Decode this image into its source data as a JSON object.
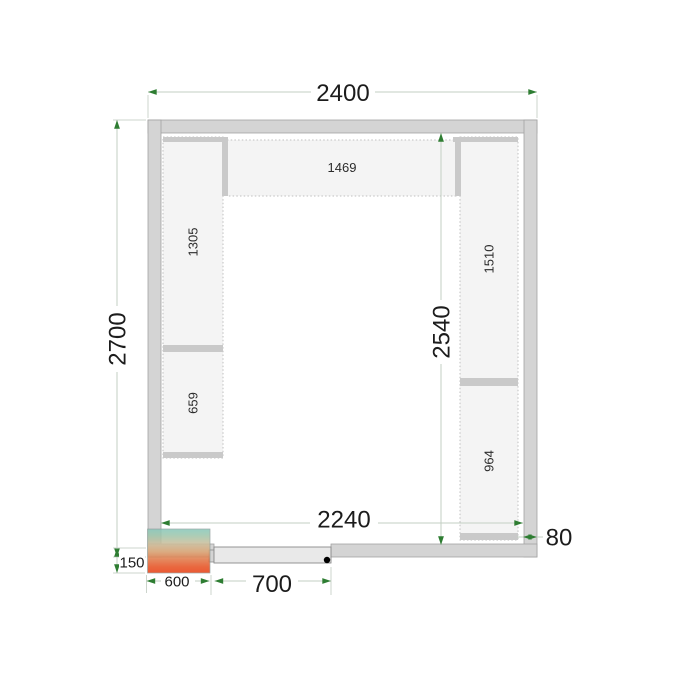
{
  "diagram": {
    "title": "cold-room-floor-plan",
    "dimensions": {
      "outer_width": "2400",
      "outer_depth": "2700",
      "inner_width": "2240",
      "inner_depth": "2540",
      "wall_thickness": "80",
      "unit_overhang": "150",
      "unit_width": "600",
      "door_opening": "700"
    },
    "shelves": {
      "top": "1469",
      "left_upper": "1305",
      "left_lower": "659",
      "right_upper": "1510",
      "right_lower": "964"
    },
    "colors": {
      "wall_fill": "#d4d4d4",
      "wall_stroke": "#a2a2a2",
      "shelf_fill": "#f4f4f4",
      "shelf_divider": "#c9c9c9",
      "dimension_line": "#c3cfc3",
      "arrow": "#2e7d32",
      "door_fill": "#e9e9e9",
      "hinge_dot": "#000000",
      "unit_gradient_top": "#86c7ba",
      "unit_gradient_mid": "#ddb183",
      "unit_gradient_bottom": "#e83c10",
      "text": "#1c1c1c"
    }
  }
}
